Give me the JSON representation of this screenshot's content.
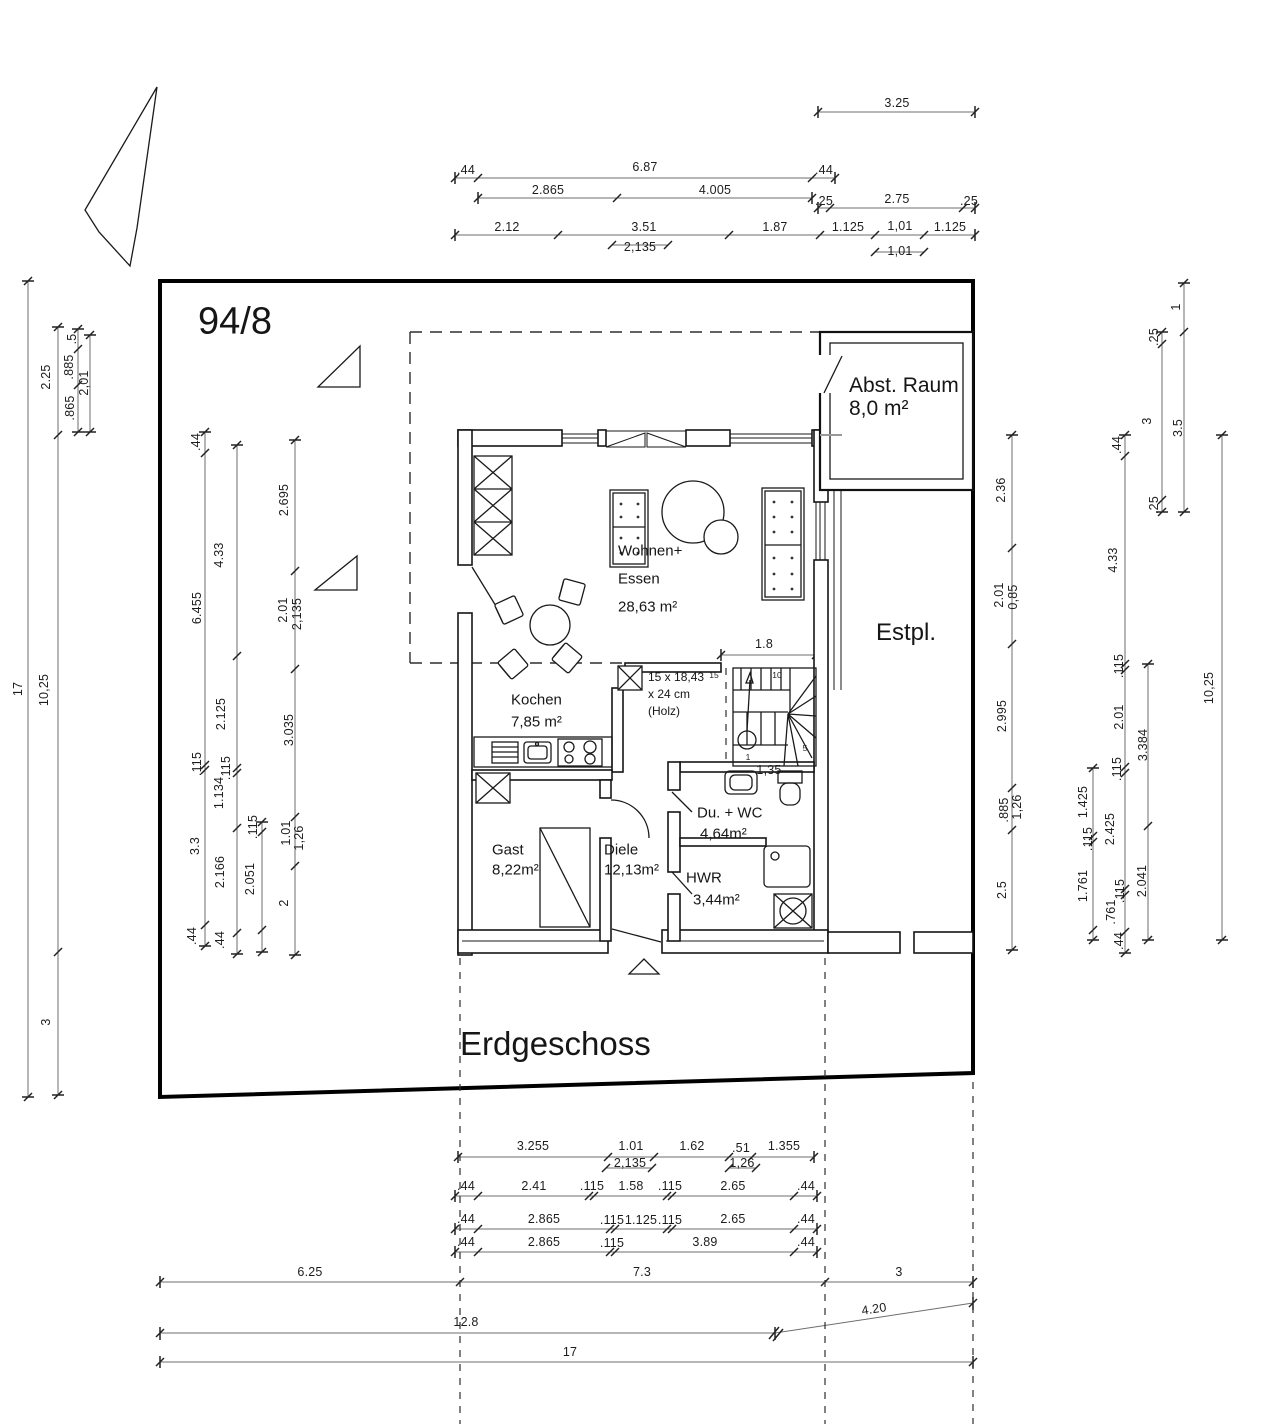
{
  "drawing": {
    "parcel_number": "94/8",
    "floor_title": "Erdgeschoss",
    "rooms": {
      "living": {
        "line1": "Wohnen+",
        "line2": "Essen",
        "area": "28,63 m²"
      },
      "kitchen": {
        "name": "Kochen",
        "area": "7,85 m²"
      },
      "guest": {
        "name": "Gast",
        "area": "8,22m²"
      },
      "hall": {
        "name": "Diele",
        "area": "12,13m²"
      },
      "bath": {
        "name": "Du. + WC",
        "area": "4,64m²"
      },
      "utility": {
        "name": "HWR",
        "area": "3,44m²"
      },
      "storage": {
        "name": "Abst. Raum",
        "area": "8,0 m²"
      },
      "parking": {
        "name": "Estpl."
      }
    },
    "stair": {
      "note1": "15 x 18,43",
      "note2": "x 24 cm",
      "note3": "(Holz)",
      "numbers": [
        "15",
        "10",
        "5",
        "1"
      ]
    }
  },
  "dim_labels": [
    {
      "t": "3.25",
      "x": 897,
      "y": 103
    },
    {
      "t": ".44",
      "x": 466,
      "y": 170
    },
    {
      "t": "6.87",
      "x": 645,
      "y": 167
    },
    {
      "t": ".44",
      "x": 824,
      "y": 170
    },
    {
      "t": "2.865",
      "x": 548,
      "y": 190
    },
    {
      "t": "4.005",
      "x": 715,
      "y": 190
    },
    {
      "t": ".25",
      "x": 824,
      "y": 201
    },
    {
      "t": "2.75",
      "x": 897,
      "y": 199
    },
    {
      "t": ".25",
      "x": 969,
      "y": 201
    },
    {
      "t": "2.12",
      "x": 507,
      "y": 227
    },
    {
      "t": "3.51",
      "x": 644,
      "y": 227
    },
    {
      "t": "1.87",
      "x": 775,
      "y": 227
    },
    {
      "t": "1.125",
      "x": 848,
      "y": 227
    },
    {
      "t": "1,01",
      "x": 900,
      "y": 226
    },
    {
      "t": "1.125",
      "x": 950,
      "y": 227
    },
    {
      "t": "2,135",
      "x": 640,
      "y": 247
    },
    {
      "t": "1,01",
      "x": 900,
      "y": 251
    },
    {
      "t": "17",
      "x": 18,
      "y": 689,
      "r": 1
    },
    {
      "t": "2.25",
      "x": 46,
      "y": 377,
      "r": 1
    },
    {
      "t": "10,25",
      "x": 44,
      "y": 690,
      "r": 1
    },
    {
      "t": "3",
      "x": 46,
      "y": 1022,
      "r": 1
    },
    {
      "t": ".5",
      "x": 72,
      "y": 339,
      "r": 1
    },
    {
      "t": ".885",
      "x": 69,
      "y": 367,
      "r": 1
    },
    {
      "t": "2,01",
      "x": 84,
      "y": 383,
      "r": 1
    },
    {
      "t": ".865",
      "x": 70,
      "y": 408,
      "r": 1
    },
    {
      "t": ".44",
      "x": 196,
      "y": 442,
      "r": 1
    },
    {
      "t": "6.455",
      "x": 197,
      "y": 608,
      "r": 1
    },
    {
      "t": ".115",
      "x": 197,
      "y": 764,
      "r": 1
    },
    {
      "t": "3.3",
      "x": 195,
      "y": 846,
      "r": 1
    },
    {
      "t": ".44",
      "x": 192,
      "y": 936,
      "r": 1
    },
    {
      "t": "4.33",
      "x": 219,
      "y": 555,
      "r": 1
    },
    {
      "t": "2.125",
      "x": 221,
      "y": 714,
      "r": 1
    },
    {
      "t": ".115",
      "x": 226,
      "y": 768,
      "r": 1
    },
    {
      "t": "1.134",
      "x": 219,
      "y": 793,
      "r": 1
    },
    {
      "t": "2.166",
      "x": 220,
      "y": 872,
      "r": 1
    },
    {
      "t": ".44",
      "x": 220,
      "y": 940,
      "r": 1
    },
    {
      "t": ".115",
      "x": 253,
      "y": 827,
      "r": 1
    },
    {
      "t": "2.051",
      "x": 250,
      "y": 879,
      "r": 1
    },
    {
      "t": "2.695",
      "x": 284,
      "y": 500,
      "r": 1
    },
    {
      "t": "2.01",
      "x": 283,
      "y": 610,
      "r": 1
    },
    {
      "t": "2,135",
      "x": 297,
      "y": 614,
      "r": 1
    },
    {
      "t": "3.035",
      "x": 289,
      "y": 730,
      "r": 1
    },
    {
      "t": "1.01",
      "x": 286,
      "y": 833,
      "r": 1
    },
    {
      "t": "1,26",
      "x": 299,
      "y": 838,
      "r": 1
    },
    {
      "t": "2",
      "x": 284,
      "y": 903,
      "r": 1
    },
    {
      "t": "1.8",
      "x": 764,
      "y": 644
    },
    {
      "t": "1,35",
      "x": 769,
      "y": 770
    },
    {
      "t": "2.36",
      "x": 1001,
      "y": 490,
      "r": 1
    },
    {
      "t": "2.01",
      "x": 999,
      "y": 595,
      "r": 1
    },
    {
      "t": "0,85",
      "x": 1013,
      "y": 597,
      "r": 1
    },
    {
      "t": "2.995",
      "x": 1002,
      "y": 716,
      "r": 1
    },
    {
      "t": ".885",
      "x": 1004,
      "y": 810,
      "r": 1
    },
    {
      "t": "1,26",
      "x": 1017,
      "y": 807,
      "r": 1
    },
    {
      "t": "2.5",
      "x": 1002,
      "y": 890,
      "r": 1
    },
    {
      "t": ".44",
      "x": 1117,
      "y": 445,
      "r": 1
    },
    {
      "t": "4.33",
      "x": 1113,
      "y": 560,
      "r": 1
    },
    {
      "t": ".115",
      "x": 1119,
      "y": 666,
      "r": 1
    },
    {
      "t": "2.01",
      "x": 1119,
      "y": 717,
      "r": 1
    },
    {
      "t": ".115",
      "x": 1117,
      "y": 769,
      "r": 1
    },
    {
      "t": "2.425",
      "x": 1110,
      "y": 829,
      "r": 1
    },
    {
      "t": ".115",
      "x": 1120,
      "y": 891,
      "r": 1
    },
    {
      "t": ".761",
      "x": 1111,
      "y": 912,
      "r": 1
    },
    {
      "t": ".44",
      "x": 1119,
      "y": 941,
      "r": 1
    },
    {
      "t": "1.425",
      "x": 1083,
      "y": 802,
      "r": 1
    },
    {
      "t": ".115",
      "x": 1088,
      "y": 839,
      "r": 1
    },
    {
      "t": "1.761",
      "x": 1083,
      "y": 886,
      "r": 1
    },
    {
      "t": "3.384",
      "x": 1143,
      "y": 745,
      "r": 1
    },
    {
      "t": "2.041",
      "x": 1142,
      "y": 881,
      "r": 1
    },
    {
      "t": "1",
      "x": 1176,
      "y": 307,
      "r": 1
    },
    {
      "t": ".25",
      "x": 1154,
      "y": 337,
      "r": 1
    },
    {
      "t": "3",
      "x": 1147,
      "y": 421,
      "r": 1
    },
    {
      "t": "3.5",
      "x": 1178,
      "y": 428,
      "r": 1
    },
    {
      "t": ".25",
      "x": 1154,
      "y": 505,
      "r": 1
    },
    {
      "t": "10,25",
      "x": 1209,
      "y": 688,
      "r": 1
    },
    {
      "t": "3.255",
      "x": 533,
      "y": 1146
    },
    {
      "t": "1.01",
      "x": 631,
      "y": 1146
    },
    {
      "t": "1.62",
      "x": 692,
      "y": 1146
    },
    {
      "t": ".51",
      "x": 741,
      "y": 1148
    },
    {
      "t": "1.355",
      "x": 784,
      "y": 1146
    },
    {
      "t": "2,135",
      "x": 630,
      "y": 1163
    },
    {
      "t": "1,26",
      "x": 742,
      "y": 1163
    },
    {
      "t": ".44",
      "x": 466,
      "y": 1186
    },
    {
      "t": "2.41",
      "x": 534,
      "y": 1186
    },
    {
      "t": ".115",
      "x": 592,
      "y": 1186
    },
    {
      "t": "1.58",
      "x": 631,
      "y": 1186
    },
    {
      "t": ".115",
      "x": 670,
      "y": 1186
    },
    {
      "t": "2.65",
      "x": 733,
      "y": 1186
    },
    {
      "t": ".44",
      "x": 806,
      "y": 1186
    },
    {
      "t": ".44",
      "x": 466,
      "y": 1219
    },
    {
      "t": "2.865",
      "x": 544,
      "y": 1219
    },
    {
      "t": ".115",
      "x": 612,
      "y": 1220
    },
    {
      "t": "1.125",
      "x": 641,
      "y": 1220
    },
    {
      "t": ".115",
      "x": 670,
      "y": 1220
    },
    {
      "t": "2.65",
      "x": 733,
      "y": 1219
    },
    {
      "t": ".44",
      "x": 806,
      "y": 1219
    },
    {
      "t": ".44",
      "x": 466,
      "y": 1242
    },
    {
      "t": "2.865",
      "x": 544,
      "y": 1242
    },
    {
      "t": ".115",
      "x": 612,
      "y": 1243
    },
    {
      "t": "3.89",
      "x": 705,
      "y": 1242
    },
    {
      "t": ".44",
      "x": 806,
      "y": 1242
    },
    {
      "t": "6.25",
      "x": 310,
      "y": 1272
    },
    {
      "t": "7.3",
      "x": 642,
      "y": 1272
    },
    {
      "t": "3",
      "x": 899,
      "y": 1272
    },
    {
      "t": "12.8",
      "x": 466,
      "y": 1322
    },
    {
      "t": "4.20",
      "x": 874,
      "y": 1309,
      "r": 2
    },
    {
      "t": "17",
      "x": 570,
      "y": 1352
    }
  ]
}
